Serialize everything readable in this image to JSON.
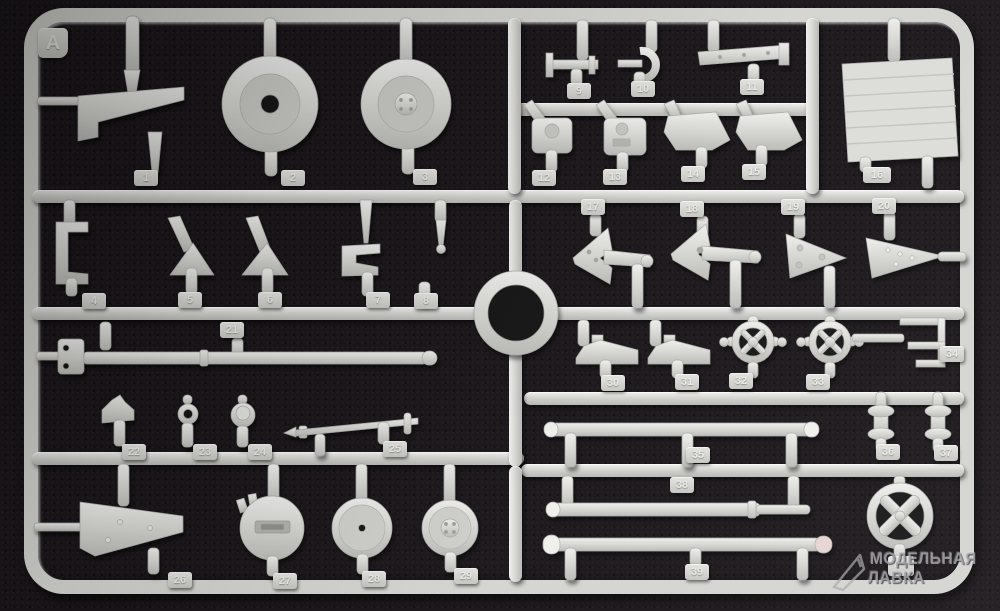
{
  "sprue": {
    "letter": "A",
    "tags": [
      "1",
      "2",
      "3",
      "4",
      "5",
      "6",
      "7",
      "8",
      "9",
      "10",
      "11",
      "12",
      "13",
      "14",
      "15",
      "16",
      "17",
      "18",
      "19",
      "20",
      "21",
      "22",
      "23",
      "24",
      "25",
      "26",
      "27",
      "28",
      "29",
      "30",
      "31",
      "32",
      "33",
      "34",
      "35",
      "36",
      "37",
      "38",
      "39"
    ],
    "obscured_tag": "",
    "plastic_color": "#d6d6d2",
    "background_color": "#1a1519"
  },
  "watermark": {
    "line1": "МОДЕЛЬНАЯ",
    "line2": "ЛАВКА"
  }
}
